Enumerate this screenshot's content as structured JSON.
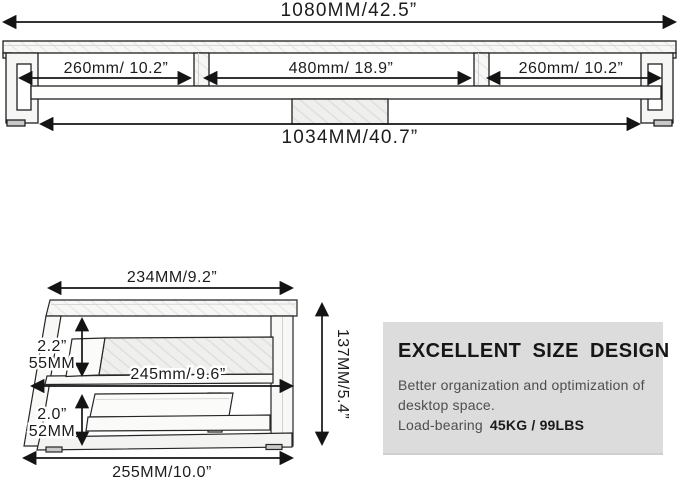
{
  "front_view": {
    "overall_width": "1080MM/42.5”",
    "compartments": {
      "left": "260mm/ 10.2”",
      "center": "480mm/ 18.9”",
      "right": "260mm/ 10.2”"
    },
    "inner_width": "1034MM/40.7”"
  },
  "side_view": {
    "top_depth": "234MM/9.2”",
    "upper_gap_inches": "2.2”",
    "upper_gap_mm": "55MM",
    "mid_depth": "245mm/ 9.6”",
    "lower_gap_inches": "2.0”",
    "lower_gap_mm": "52MM",
    "base_depth": "255MM/10.0”",
    "overall_height": "137MM/5.4”"
  },
  "info_box": {
    "title": "EXCELLENT SIZE DESIGN",
    "body_line1": "Better organization and optimization of",
    "body_line2": "desktop space.",
    "load_label": "Load-bearing",
    "load_value": "45KG / 99LBS",
    "background": "#dcdcdc"
  },
  "colors": {
    "page_background": "#ffffff",
    "line_color": "#141414",
    "label_text": "#1c1c1c",
    "body_text": "#4e4e4e",
    "info_box_background": "#dcdcdc",
    "wood_hatch": "#e3e3e1"
  }
}
